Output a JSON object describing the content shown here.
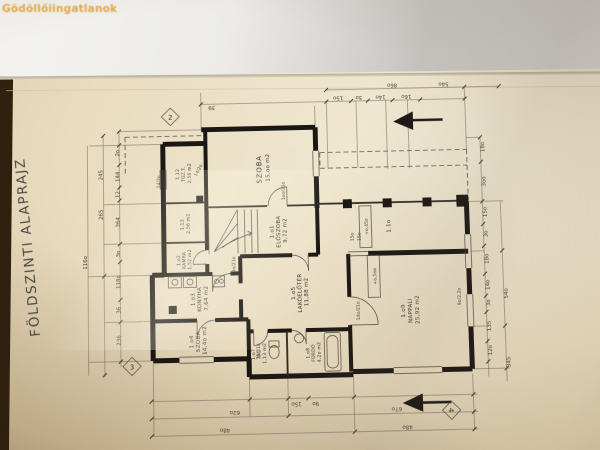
{
  "watermark": "Gödöllőiingatlanok",
  "plan": {
    "title": "FÖLDSZINTI ALAPRAJZ",
    "rooms": [
      {
        "id": "1.12",
        "name": "TÜZ.T.",
        "area": "2,56 m2"
      },
      {
        "id": "1.13",
        "name": "",
        "area": "2,56 m2"
      },
      {
        "id": "",
        "name": "SZOBA",
        "area": "15,oo m2"
      },
      {
        "id": "1.o1",
        "name": "ELŐSZOBA",
        "area": "9,72 m2"
      },
      {
        "id": "1.o2",
        "name": "KAMRA",
        "area": "1,52 m2"
      },
      {
        "id": "1.o3",
        "name": "KONYHA",
        "area": "7,64 m2"
      },
      {
        "id": "1.o4",
        "name": "SZOBA",
        "area": "14,4o m2"
      },
      {
        "id": "1.o5",
        "name": "LAKÓELŐTÉR",
        "area": "11,88 m2"
      },
      {
        "id": "1.o7",
        "name": "WC",
        "area": "1,13 m2"
      },
      {
        "id": "1.o8",
        "name": "FÜRDŐ",
        "area": "4,2o m2"
      },
      {
        "id": "1.o9",
        "name": "NAPPALI",
        "area": "25,92 m2"
      },
      {
        "id": "1.1o",
        "name": "",
        "area": ""
      }
    ],
    "levels": {
      "terrace": "+o,45o",
      "main": "+o,5oo"
    },
    "axes": [
      "2",
      "3",
      "4"
    ],
    "dims": {
      "left_outer": [
        "245",
        "265",
        "116o"
      ],
      "left_inner": [
        "2o",
        "144",
        "12",
        "364",
        "3o",
        "118o",
        "36",
        "236"
      ],
      "right_inner": [
        "18o",
        "3oo",
        "15o",
        "3o",
        "18o",
        "14o",
        "3o",
        "135",
        "12o"
      ],
      "right_outer": [
        "54o",
        "345"
      ],
      "top": [
        "39",
        "15o",
        "3o",
        "14o",
        "16o",
        "86o",
        "54o"
      ],
      "bottom": [
        "62o",
        "48o",
        "15o",
        "9o",
        "67o",
        "48o"
      ],
      "openings": [
        "1oo/21o",
        "9o/21o",
        "75/21o",
        "9o/2,2o",
        "14/2o",
        "14/2o",
        "15o",
        "15o",
        "14o/21o"
      ]
    }
  }
}
